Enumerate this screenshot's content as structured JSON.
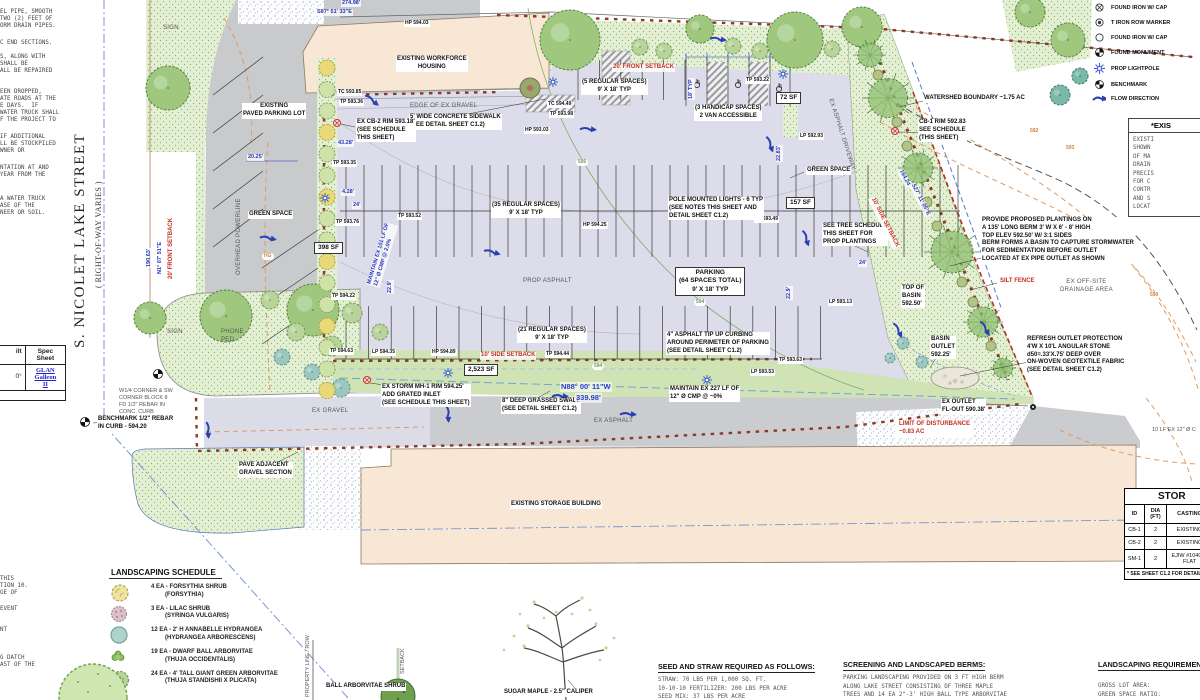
{
  "street": {
    "name": "S. NICOLET LAKE STREET",
    "row_note": "( RIGHT-OF-WAY VARIES )"
  },
  "colors": {
    "green_space": "#e2efd2",
    "prop_asphalt": "#dcdcea",
    "building_tan": "#f9e7d5",
    "setback_red": "#c03020",
    "dimension_blue": "#2233bb",
    "brick_boundary": "#8d3a22",
    "contour_orange": "#e09a60",
    "flow_blue": "#2b3fb5"
  },
  "legend": {
    "items": [
      {
        "icon": "circle-x",
        "label": "FOUND IRON W/ CAP"
      },
      {
        "icon": "circle-dot",
        "label": "T IRON ROW MARKER"
      },
      {
        "icon": "circle",
        "label": "FOUND IRON W/ CAP"
      },
      {
        "icon": "monument",
        "label": "FOUND MONUMENT"
      },
      {
        "icon": "lightpole",
        "label": "PROP LIGHTPOLE"
      },
      {
        "icon": "benchmark",
        "label": "BENCHMARK"
      },
      {
        "icon": "flow-arrow",
        "label": "FLOW DIRECTION"
      }
    ]
  },
  "existing_note_box": {
    "title": "*EXIS",
    "lines": [
      "EXISTI",
      "SHOWN",
      "OF MA",
      "DRAIN",
      "PRECIS",
      "FOR C",
      "CONTR",
      "AND S",
      "LOCAT"
    ]
  },
  "storm_table": {
    "title": "STOR",
    "headers": [
      "ID",
      "DIA\n(FT)",
      "CASTING",
      ""
    ],
    "rows": [
      [
        "CB-1",
        "2",
        "EXISTING",
        ""
      ],
      [
        "CB-2",
        "2",
        "EXISTING",
        ""
      ],
      [
        "SM-1",
        "2",
        "EJIW #1040 M\nFLAT",
        ""
      ]
    ],
    "footnote": "* SEE SHEET C1.2 FOR DETAIL"
  },
  "landscaping_schedule": {
    "title": "LANDSCAPING SCHEDULE",
    "items": [
      {
        "icon": "forsythia",
        "qty": "4 EA - FORSYTHIA SHRUB",
        "species": "(FORSYTHIA)"
      },
      {
        "icon": "lilac",
        "qty": "3 EA - LILAC SHRUB",
        "species": "(SYRINGA VULGARIS)"
      },
      {
        "icon": "hydrangea",
        "qty": "12 EA - 2' H ANNABELLE HYDRANGEA",
        "species": "(HYDRANGEA ARBORESCENS)"
      },
      {
        "icon": "dwarf-arborvitae",
        "qty": "19 EA - DWARF BALL ARBORVITAE",
        "species": "(THUJA OCCIDENTALIS)"
      },
      {
        "icon": "giant-arborvitae",
        "qty": "24 EA - 4' TALL GIANT GREEN ARBORVITAE",
        "species": "(THUJA STANDISHII X PLICATA)"
      }
    ]
  },
  "seed_notes": {
    "title": "SEED AND STRAW REQUIRED AS FOLLOWS:",
    "lines": [
      "STRAW: 70 LBS PER 1,000 SQ. FT.",
      "10-10-10 FERTILIZER: 200 LBS PER ACRE",
      "SEED MIX: 37 LBS PER ACRE"
    ]
  },
  "screening_notes": {
    "title": "SCREENING AND LANDSCAPED BERMS:",
    "lines": [
      "PARKING LANDSCAPING PROVIDED ON 3 FT HIGH BERM",
      "ALONG LAKE STREET CONSISTING OF THREE MAPLE",
      "TREES AND 14 EA 2\"-3' HIGH BALL TYPE ARBORVITAE",
      "SHRUBS"
    ]
  },
  "landscaping_requirements": {
    "title": "LANDSCAPING REQUIREMENT",
    "lines": [
      "GROSS LOT AREA:",
      "GREEN SPACE RATIO:",
      "REQUIRED GREEN SPACE"
    ]
  },
  "spec_table": {
    "col1_header": "ilt",
    "col2_header": "Spec\nSheet",
    "col1_value": "0°",
    "col2_value": "GLAN\nGalleon\nII"
  },
  "left_notes_fragments": [
    {
      "t": "EL PIPE, SMOOTH",
      "y": 9
    },
    {
      "t": "TWO (2) FEET OF",
      "y": 16
    },
    {
      "t": "ORM DRAIN PIPES.",
      "y": 23
    },
    {
      "t": "C END SECTIONS.",
      "y": 40
    },
    {
      "t": "S, ALONG WITH",
      "y": 54
    },
    {
      "t": "SHALL BE",
      "y": 61
    },
    {
      "t": "ALL BE REPAIRED",
      "y": 68
    },
    {
      "t": "EEN DROPPED,",
      "y": 89
    },
    {
      "t": "ATE ROADS AT THE",
      "y": 96
    },
    {
      "t": "E DAYS.  IF",
      "y": 103
    },
    {
      "t": "WATER TRUCK SHALL",
      "y": 110
    },
    {
      "t": "F THE PROJECT TO",
      "y": 117
    },
    {
      "t": "IF ADDITIONAL",
      "y": 134
    },
    {
      "t": "LL BE STOCKPILED",
      "y": 141
    },
    {
      "t": "WNER OR",
      "y": 148
    },
    {
      "t": "NTATION AT AND",
      "y": 165
    },
    {
      "t": "YEAR FROM THE",
      "y": 172
    },
    {
      "t": "A WATER TRUCK",
      "y": 196
    },
    {
      "t": "ASE OF THE",
      "y": 203
    },
    {
      "t": "NEER OR SOIL.",
      "y": 210
    }
  ],
  "bottom_left_fragments": [
    {
      "t": "THIS",
      "y": 576
    },
    {
      "t": "TION 10.",
      "y": 583
    },
    {
      "t": "GE OF",
      "y": 590
    },
    {
      "t": "EVENT",
      "y": 606
    },
    {
      "t": "NT",
      "y": 627
    },
    {
      "t": "G DATCH",
      "y": 655
    },
    {
      "t": "AST OF THE",
      "y": 662
    }
  ],
  "annotations": [
    {
      "t": "274.98'",
      "x": 341,
      "y": 0,
      "c": "dim"
    },
    {
      "t": "S87° 51' 33\"E",
      "x": 316,
      "y": 9,
      "c": "dim"
    },
    {
      "t": "EXISTING WORKFORCE\nHOUSING",
      "x": 396,
      "y": 56,
      "c": "lbl",
      "a": "c"
    },
    {
      "t": "EXISTING\nPAVED PARKING LOT",
      "x": 242,
      "y": 103,
      "c": "lbl",
      "a": "c"
    },
    {
      "t": "20' FRONT SETBACK",
      "x": 612,
      "y": 64,
      "c": "red"
    },
    {
      "t": "(5 REGULAR SPACES)\n9' X 18' TYP",
      "x": 581,
      "y": 79,
      "c": "lbl",
      "a": "c"
    },
    {
      "t": "(3 HANDICAP SPACES)\n2 VAN ACCESSIBLE",
      "x": 694,
      "y": 105,
      "c": "lbl",
      "a": "c"
    },
    {
      "t": "72 SF",
      "x": 776,
      "y": 92,
      "c": "lblb"
    },
    {
      "t": "TP 593.22",
      "x": 745,
      "y": 77,
      "c": "spot"
    },
    {
      "t": "HP 594.03",
      "x": 404,
      "y": 20,
      "c": "spot"
    },
    {
      "t": "TC 593.85",
      "x": 337,
      "y": 89,
      "c": "spot"
    },
    {
      "t": "TP 593.36",
      "x": 339,
      "y": 99,
      "c": "spot"
    },
    {
      "t": "TC 594.49",
      "x": 547,
      "y": 101,
      "c": "spot"
    },
    {
      "t": "TP 593.98",
      "x": 549,
      "y": 111,
      "c": "spot"
    },
    {
      "t": "HP 593.03",
      "x": 524,
      "y": 127,
      "c": "spot"
    },
    {
      "t": "EDGE OF EX GRAVEL",
      "x": 410,
      "y": 103,
      "c": "gray"
    },
    {
      "t": "5' WIDE CONCRETE SIDEWALK\n(SEE DETAIL SHEET C1.2)",
      "x": 409,
      "y": 114,
      "c": "lbl"
    },
    {
      "t": "EX CB-2 RIM 593.18'\n(SEE SCHEDULE\nTHIS SHEET)",
      "x": 356,
      "y": 119,
      "c": "lbl"
    },
    {
      "t": "TP 593.35",
      "x": 332,
      "y": 160,
      "c": "spot"
    },
    {
      "t": "4.28'",
      "x": 341,
      "y": 189,
      "c": "dim"
    },
    {
      "t": "24'",
      "x": 352,
      "y": 202,
      "c": "dim"
    },
    {
      "t": "20.25'",
      "x": 247,
      "y": 154,
      "c": "dim"
    },
    {
      "t": "43.28'",
      "x": 337,
      "y": 140,
      "c": "dim"
    },
    {
      "t": "GREEN SPACE",
      "x": 248,
      "y": 211,
      "c": "lbl"
    },
    {
      "t": "TP 593.76",
      "x": 335,
      "y": 219,
      "c": "spot"
    },
    {
      "t": "398 SF",
      "x": 314,
      "y": 242,
      "c": "lblb"
    },
    {
      "t": "TP 594.22",
      "x": 331,
      "y": 293,
      "c": "spot"
    },
    {
      "t": "190.63'",
      "x": 146,
      "y": 268,
      "c": "dim",
      "r": -90
    },
    {
      "t": "N1° 07' 51\"E",
      "x": 157,
      "y": 275,
      "c": "dim",
      "r": -90
    },
    {
      "t": "20' FRONT SETBACK",
      "x": 168,
      "y": 280,
      "c": "red",
      "r": -90
    },
    {
      "t": "OVERHEAD POWERLINE",
      "x": 236,
      "y": 275,
      "c": "gray",
      "r": -90
    },
    {
      "t": "SIGN",
      "x": 163,
      "y": 25,
      "c": "gray"
    },
    {
      "t": "SIGN",
      "x": 167,
      "y": 329,
      "c": "gray"
    },
    {
      "t": "PHONE\nPED.",
      "x": 221,
      "y": 329,
      "c": "gray"
    },
    {
      "t": "(35 REGULAR SPACES)\n9' X 18' TYP",
      "x": 491,
      "y": 202,
      "c": "lbl",
      "a": "c"
    },
    {
      "t": "TP 593.52",
      "x": 397,
      "y": 213,
      "c": "spot"
    },
    {
      "t": "HP 594.25",
      "x": 582,
      "y": 222,
      "c": "spot"
    },
    {
      "t": "TP 593.49",
      "x": 754,
      "y": 216,
      "c": "spot"
    },
    {
      "t": "POLE MOUNTED LIGHTS - 6 TYP\n(SEE NOTES THIS SHEET AND\nDETAIL SHEET C1.2)",
      "x": 668,
      "y": 197,
      "c": "lbl"
    },
    {
      "t": "PROP ASPHALT",
      "x": 523,
      "y": 278,
      "c": "gray"
    },
    {
      "t": "PARKING\n(64 SPACES TOTAL)\n9' X 18' TYP",
      "x": 675,
      "y": 267,
      "c": "lblb",
      "a": "c"
    },
    {
      "t": "(21 REGULAR SPACES)\n9' X 18' TYP",
      "x": 517,
      "y": 327,
      "c": "lbl",
      "a": "c"
    },
    {
      "t": "4\" ASPHALT TIP UP CURBING\nAROUND PERIMETER OF PARKING\n(SEE DETAIL SHEET C1.2)",
      "x": 666,
      "y": 332,
      "c": "lbl"
    },
    {
      "t": "GREEN SPACE",
      "x": 806,
      "y": 167,
      "c": "lbl"
    },
    {
      "t": "157 SF",
      "x": 786,
      "y": 197,
      "c": "lblb"
    },
    {
      "t": "LP 592.93",
      "x": 799,
      "y": 133,
      "c": "spot"
    },
    {
      "t": "SEE TREE SCHEDULE\nTHIS SHEET FOR\nPROP PLANTINGS",
      "x": 822,
      "y": 223,
      "c": "lbl"
    },
    {
      "t": "24'",
      "x": 858,
      "y": 260,
      "c": "dim"
    },
    {
      "t": "LP 593.13",
      "x": 828,
      "y": 299,
      "c": "spot"
    },
    {
      "t": "22.9'",
      "x": 786,
      "y": 300,
      "c": "dim",
      "r": -90
    },
    {
      "t": "22.9'",
      "x": 387,
      "y": 294,
      "c": "dim",
      "r": -90
    },
    {
      "t": "22.83'",
      "x": 776,
      "y": 162,
      "c": "dim",
      "r": -90
    },
    {
      "t": "18' TYP",
      "x": 688,
      "y": 100,
      "c": "dim",
      "r": -90
    },
    {
      "t": "EX ASPHALT DRIVEWAY",
      "x": 833,
      "y": 98,
      "c": "gray",
      "r": 72
    },
    {
      "t": "CB-1 RIM 592.83\nSEE SCHEDULE\n(THIS SHEET)",
      "x": 918,
      "y": 119,
      "c": "lbl"
    },
    {
      "t": "WATERSHED BOUNDARY ~1.75 AC",
      "x": 923,
      "y": 95,
      "c": "lbl"
    },
    {
      "t": "10' SIDE SETBACK",
      "x": 875,
      "y": 196,
      "c": "red",
      "r": 63
    },
    {
      "t": "164.24'",
      "x": 903,
      "y": 168,
      "c": "dim",
      "r": 63
    },
    {
      "t": "S27° 11' 05\"E",
      "x": 915,
      "y": 182,
      "c": "dim",
      "r": 63
    },
    {
      "t": "PROVIDE PROPOSED PLANTINGS ON\nA 135' LONG BERM 3' W X 6' - 8' HIGH\nTOP ELEV 592.50' W/ 3:1 SIDES\nBERM FORMS A BASIN TO CAPTURE STORMWATER\nFOR SEDIMENTATION BEFORE OUTLET\nLOCATED AT EX PIPE OUTLET AS SHOWN",
      "x": 981,
      "y": 217,
      "c": "lbl"
    },
    {
      "t": "SILT FENCE",
      "x": 999,
      "y": 278,
      "c": "red"
    },
    {
      "t": "EX OFF-SITE\nDRAINAGE AREA",
      "x": 1060,
      "y": 279,
      "c": "gray",
      "a": "c"
    },
    {
      "t": "TOP OF\nBASIN\n592.50'",
      "x": 901,
      "y": 285,
      "c": "lbl"
    },
    {
      "t": "BASIN\nOUTLET\n592.25'",
      "x": 930,
      "y": 336,
      "c": "lbl"
    },
    {
      "t": "REFRESH OUTLET PROTECTION\n4'W X 10'L ANGULAR STONE\nd50=.33'X.75' DEEP OVER\nON-WOVEN GEOTEXTILE FABRIC\n(SEE DETAIL SHEET C1.2)",
      "x": 1026,
      "y": 336,
      "c": "lbl"
    },
    {
      "t": "EX OUTLET\nFL-OUT 590.38'",
      "x": 941,
      "y": 399,
      "c": "lbl"
    },
    {
      "t": "LIMIT OF DISTURBANCE\n~0.83 AC",
      "x": 897,
      "y": 420,
      "c": "redp"
    },
    {
      "t": "10 LF EX 12\" Ø C",
      "x": 1152,
      "y": 427,
      "c": "graysm"
    },
    {
      "t": "TP 594.63",
      "x": 329,
      "y": 348,
      "c": "spot"
    },
    {
      "t": "LP 594.35",
      "x": 371,
      "y": 349,
      "c": "spot"
    },
    {
      "t": "HP 594.89",
      "x": 431,
      "y": 349,
      "c": "spot"
    },
    {
      "t": "10' SIDE SETBACK",
      "x": 480,
      "y": 352,
      "c": "red"
    },
    {
      "t": "TP 594.44",
      "x": 545,
      "y": 351,
      "c": "spot"
    },
    {
      "t": "2,523 SF",
      "x": 464,
      "y": 364,
      "c": "lblb"
    },
    {
      "t": "TP 593.63",
      "x": 778,
      "y": 357,
      "c": "spot"
    },
    {
      "t": "LP 593.53",
      "x": 750,
      "y": 369,
      "c": "spot"
    },
    {
      "t": "EX STORM MH-1 RIM 594.25'\nADD GRATED INLET\n(SEE SCHEDULE THIS SHEET)",
      "x": 381,
      "y": 384,
      "c": "lbl"
    },
    {
      "t": "8\" DEEP GRASSED SWALE\n(SEE DETAIL SHEET C1.2)",
      "x": 501,
      "y": 398,
      "c": "lbl"
    },
    {
      "t": "N88° 00' 11\"W",
      "x": 560,
      "y": 382,
      "c": "dim2"
    },
    {
      "t": "339.98'",
      "x": 575,
      "y": 393,
      "c": "dim2"
    },
    {
      "t": "MAINTAIN EX 227 LF OF\n12\" Ø CMP @ ~0%",
      "x": 669,
      "y": 386,
      "c": "lbl"
    },
    {
      "t": "MAINTAIN EX 101 LF OF\n12\" Ø CMP @ 2.0%",
      "x": 366,
      "y": 284,
      "c": "dim",
      "r": -73
    },
    {
      "t": "EX GRAVEL",
      "x": 312,
      "y": 408,
      "c": "gray"
    },
    {
      "t": "EX ASPHALT",
      "x": 594,
      "y": 418,
      "c": "gray"
    },
    {
      "t": "W1/4 CORNER & SW\nCORNER BLOCK 8\nFD 1/2\" REBAR IN\nCONC. CURB",
      "x": 119,
      "y": 388,
      "c": "graysm"
    },
    {
      "t": "BENCHMARK 1/2\" REBAR\nIN CURB - 594.20",
      "x": 97,
      "y": 416,
      "c": "lbl"
    },
    {
      "t": "PAVE ADJACENT\nGRAVEL SECTION",
      "x": 238,
      "y": 462,
      "c": "lbl"
    },
    {
      "t": "EXISTING STORAGE BUILDING",
      "x": 510,
      "y": 501,
      "c": "lbl"
    },
    {
      "t": "592",
      "x": 1028,
      "y": 128,
      "c": "orange"
    },
    {
      "t": "593",
      "x": 1064,
      "y": 145,
      "c": "orange"
    },
    {
      "t": "590",
      "x": 1148,
      "y": 292,
      "c": "orange"
    },
    {
      "t": "HG",
      "x": 262,
      "y": 253,
      "c": "orange"
    },
    {
      "t": "595",
      "x": 576,
      "y": 159,
      "c": "greenlb"
    },
    {
      "t": "594",
      "x": 694,
      "y": 299,
      "c": "greenlb"
    },
    {
      "t": "594",
      "x": 592,
      "y": 363,
      "c": "greenlb"
    },
    {
      "t": "PROPERTY LINE / ROW",
      "x": 305,
      "y": 697,
      "c": "graysm",
      "r": -90
    },
    {
      "t": "SETBACK",
      "x": 400,
      "y": 674,
      "c": "graysm",
      "r": -90
    },
    {
      "t": "BALL ARBORVITAE SHRUB",
      "x": 325,
      "y": 683,
      "c": "lbl"
    },
    {
      "t": "SUGAR MAPLE - 2.5\" CALIPER",
      "x": 503,
      "y": 689,
      "c": "lbl"
    }
  ]
}
